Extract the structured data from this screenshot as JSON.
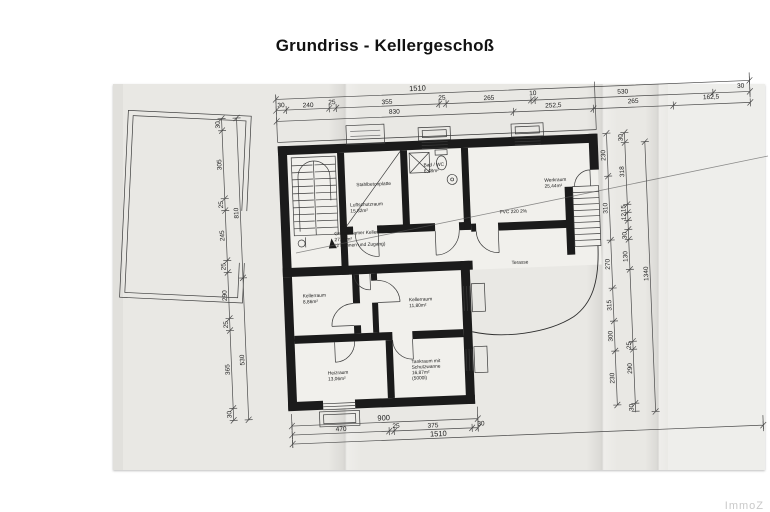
{
  "title": "Grundriss - Kellergeschoß",
  "watermark": "ImmoZ",
  "rooms": {
    "slab": {
      "line1": "Stahlbetonplatte"
    },
    "shelter": {
      "line1": "Luftschutzraum",
      "line2": "15,82m²"
    },
    "bath": {
      "line1": "Bad / WC",
      "line2": "6,48m²"
    },
    "work": {
      "line1": "Werkraum",
      "line2": "25,44m²"
    },
    "common": {
      "line1": "Gemeinsamer Keller",
      "line2": "27,81m²",
      "line3": "(2 Bahnen und Zugang)"
    },
    "terrace": {
      "line1": "Terasse"
    },
    "cellar1": {
      "line1": "Kellerraum",
      "line2": "8,86m²"
    },
    "cellar2": {
      "line1": "Kellerraum",
      "line2": "11,80m²"
    },
    "heating": {
      "line1": "Heizraum",
      "line2": "13,06m²"
    },
    "tank": {
      "line1": "Tankraum mit",
      "line2": "Schutzwanne",
      "line3": "16,87m²",
      "line4": "(5000l)"
    }
  },
  "notes": {
    "floor": "PVC 220 2%"
  },
  "dims": {
    "top1": "1510",
    "top2": [
      "30",
      "240",
      "25",
      "355",
      "25",
      "265",
      "10",
      "530",
      "30"
    ],
    "top3": [
      "830",
      "252,5",
      "265",
      "162,5"
    ],
    "left1": [
      "30",
      "305",
      "25",
      "245",
      "25",
      "290",
      "25",
      "365",
      "30"
    ],
    "left2": [
      "810",
      "530"
    ],
    "right1": [
      "230",
      "310",
      "270",
      "315",
      "300",
      "230"
    ],
    "right2": [
      "30",
      "318",
      "15",
      "12",
      "30",
      "130",
      "25",
      "290",
      "30"
    ],
    "right3": "1340",
    "bottom1": "900",
    "bottom2": [
      "470",
      "25",
      "375",
      "30"
    ],
    "bottom3": "1510"
  }
}
